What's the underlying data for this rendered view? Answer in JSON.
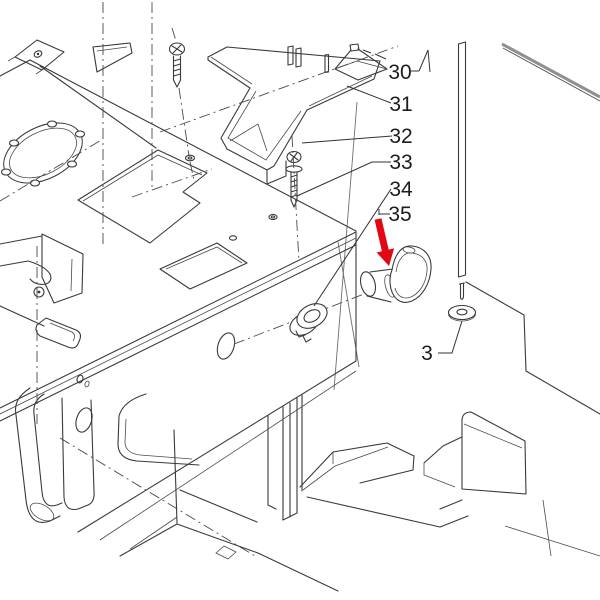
{
  "diagram": {
    "kind": "exploded-parts-line-drawing",
    "background_color": "#ffffff",
    "line_color": "#3a3a3a",
    "arrow_color": "#e30613",
    "callouts": [
      {
        "label": "30"
      },
      {
        "label": "31"
      },
      {
        "label": "32"
      },
      {
        "label": "33"
      },
      {
        "label": "34"
      },
      {
        "label": "35"
      },
      {
        "label": "3"
      }
    ],
    "pointer": {
      "name": "red-arrow",
      "points_to_label": "35"
    }
  }
}
